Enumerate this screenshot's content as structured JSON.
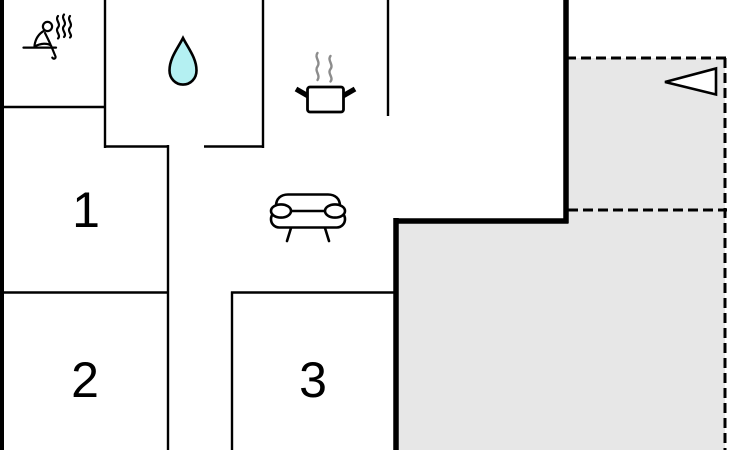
{
  "plan": {
    "type": "floor-plan",
    "rooms": [
      {
        "id": "room-1",
        "label": "1"
      },
      {
        "id": "room-2",
        "label": "2"
      },
      {
        "id": "room-3",
        "label": "3"
      }
    ],
    "icons": [
      {
        "name": "sauna-icon"
      },
      {
        "name": "water-drop-icon"
      },
      {
        "name": "cooking-pot-icon"
      },
      {
        "name": "sofa-icon"
      },
      {
        "name": "entrance-arrow-icon"
      }
    ]
  },
  "colors": {
    "wall": "#000000",
    "terrace_fill": "#e7e7e7",
    "water_drop_fill": "#b4f0f2",
    "steam_gray": "#8c8c8c",
    "arrow_fill": "#ffffff",
    "background": "#ffffff"
  }
}
